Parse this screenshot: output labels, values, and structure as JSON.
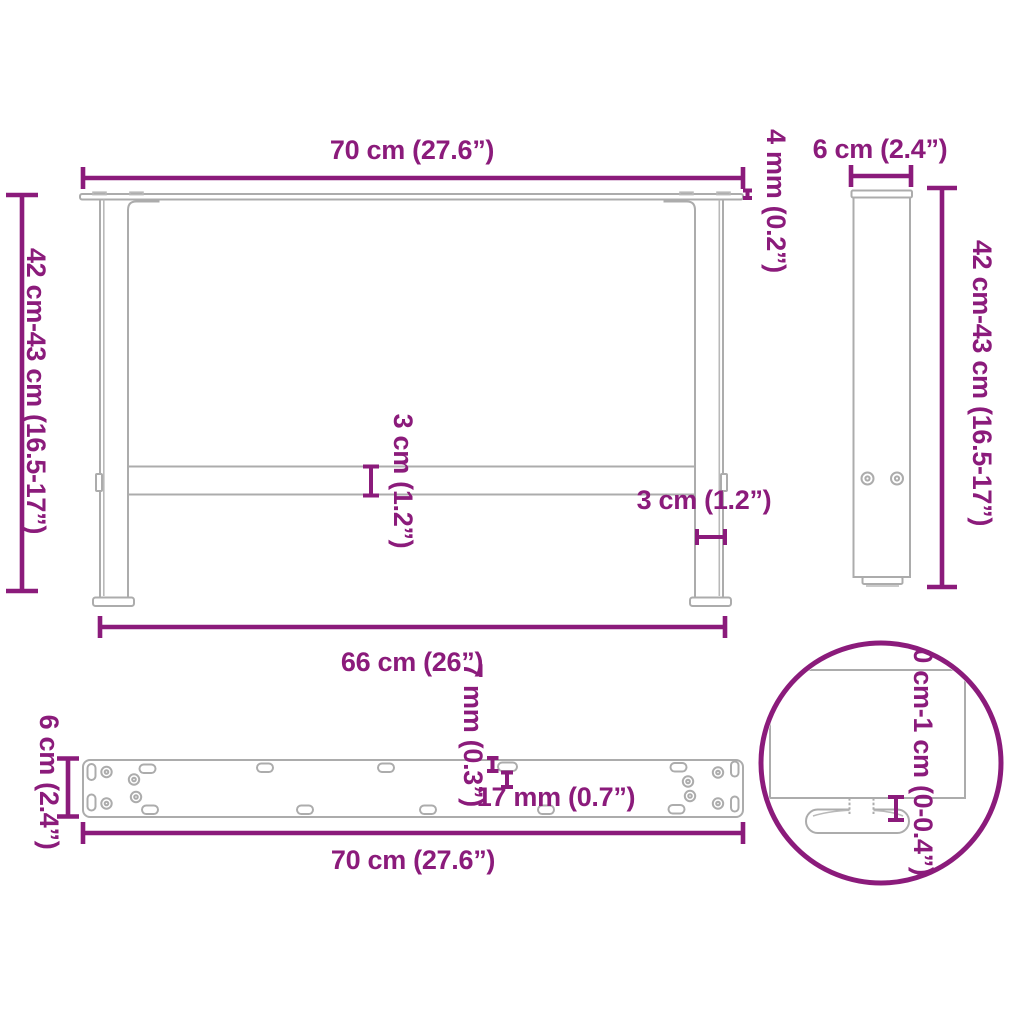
{
  "colors": {
    "dimension_accent": "#8B1B7B",
    "drawing_line": "#ACACAC",
    "background": "#FFFFFF"
  },
  "front_view": {
    "width_label": "70 cm (27.6”)",
    "tabletop_thickness_label": "4 mm (0.2”)",
    "height_label": "42 cm-43 cm (16.5-17”)",
    "crossbar_label": "3 cm (1.2”)",
    "leg_width_label": "3 cm (1.2”)",
    "base_span_label": "66 cm (26”)"
  },
  "side_view": {
    "depth_label": "6 cm (2.4”)",
    "height_label": "42 cm-43 cm (16.5-17”)"
  },
  "mounting_plate_view": {
    "depth_label": "6 cm (2.4”)",
    "slot_width_label": "7 mm (0.3”)",
    "slot_length_label": "17 mm (0.7”)",
    "length_label": "70 cm (27.6”)"
  },
  "foot_detail_view": {
    "height_adjustment_label": "0 cm-1 cm (0-0.4”)"
  }
}
